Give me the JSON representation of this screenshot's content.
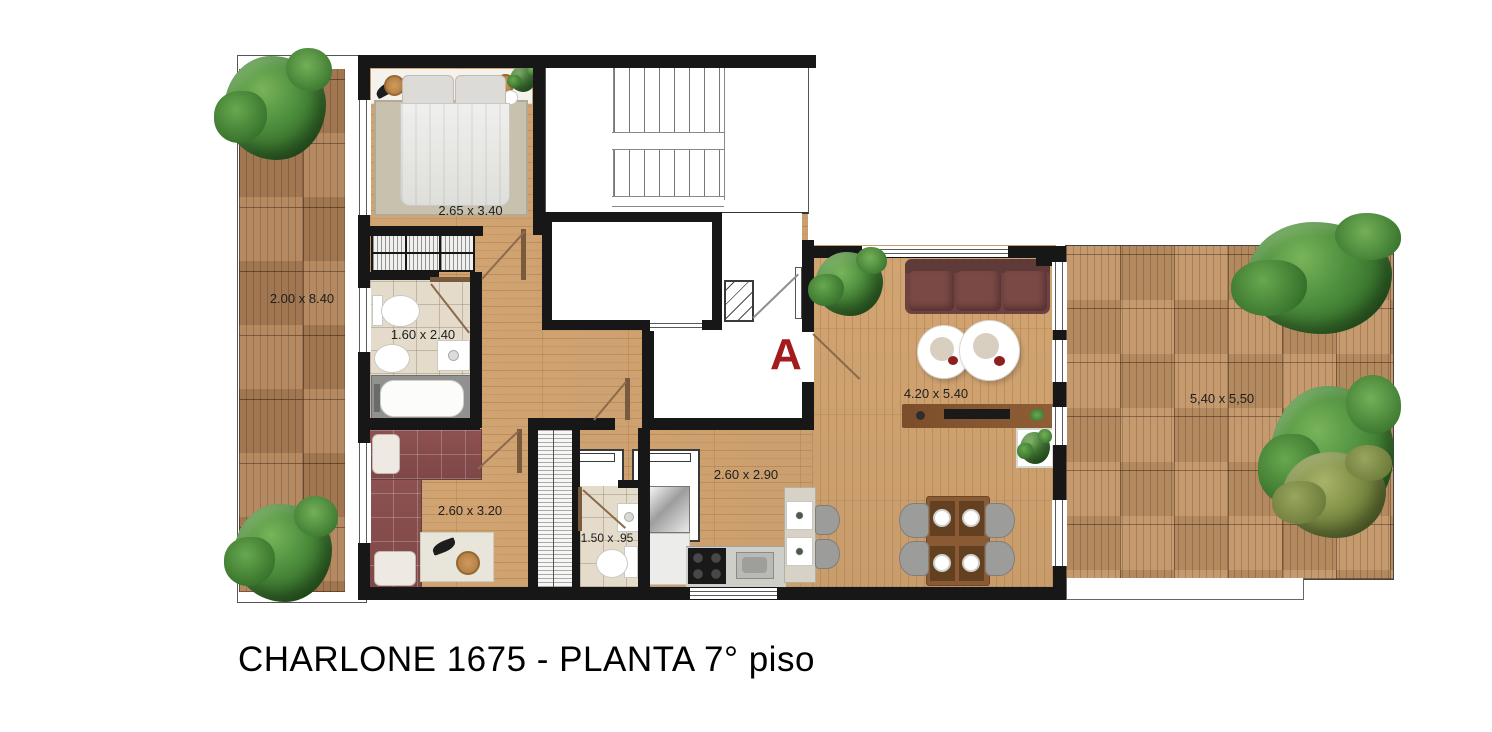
{
  "title": "CHARLONE 1675 - PLANTA 7° piso",
  "section_marker": "A",
  "colors": {
    "accent_red": "#a31b1b",
    "wall_black": "#171717",
    "apartment_floor": "#cda06d",
    "deck_left": "#b1835a",
    "deck_right": "#c29567",
    "sofa_maroon": "#6d4240",
    "bed_maroon": "#8d5151",
    "tree_green": "#4e8f3e"
  },
  "rooms": {
    "terrace_left": {
      "dimensions": "2.00 x 8.40"
    },
    "bedroom_main": {
      "dimensions": "2.65 x 3.40"
    },
    "bathroom_main": {
      "dimensions": "1.60 x 2.40"
    },
    "bedroom_second": {
      "dimensions": "2.60 x 3.20"
    },
    "toilette": {
      "dimensions": "1.50 x .95"
    },
    "kitchen_dining": {
      "dimensions": "2.60 x 2.90"
    },
    "living": {
      "dimensions": "4.20 x 5.40"
    },
    "terrace_right": {
      "dimensions": "5,40 x 5,50"
    }
  }
}
